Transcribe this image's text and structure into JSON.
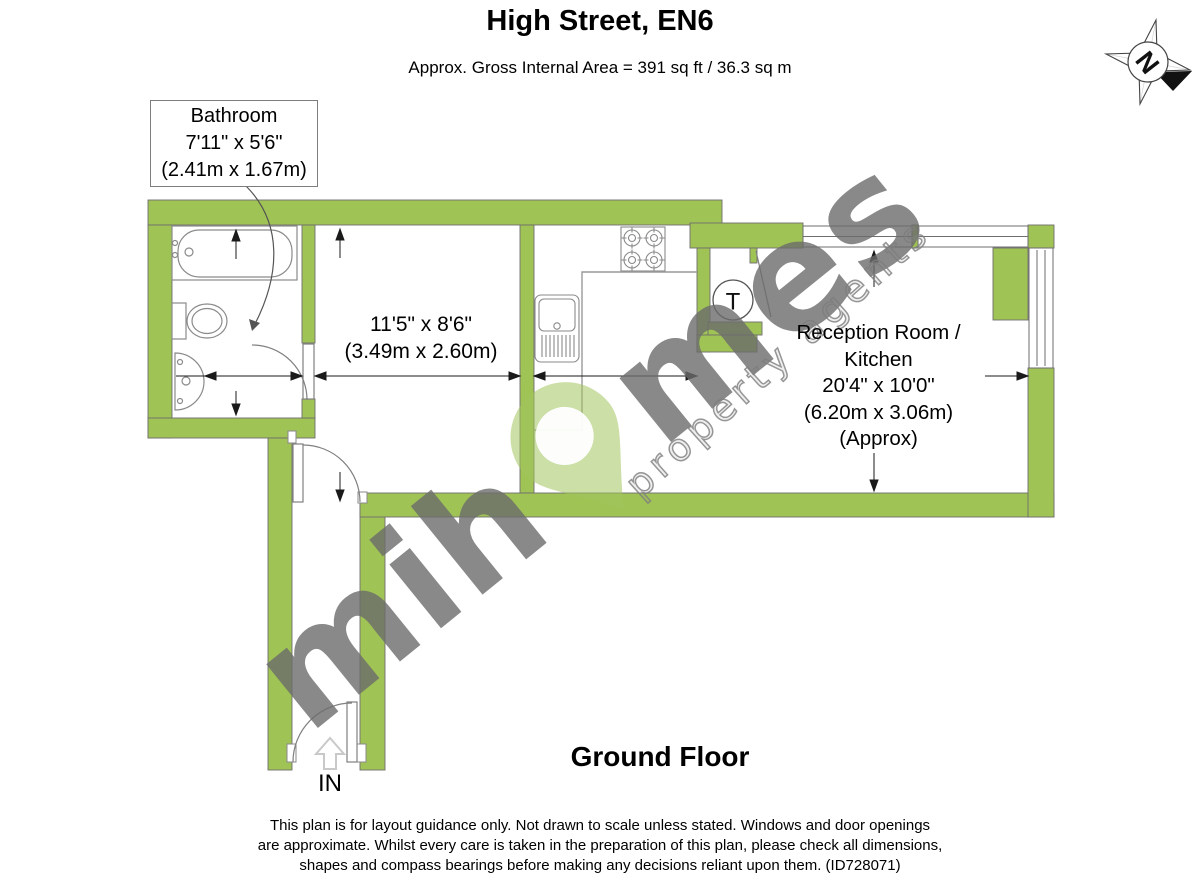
{
  "header": {
    "title": "High Street, EN6",
    "subtitle": "Approx. Gross Internal Area = 391 sq ft / 36.3 sq m"
  },
  "compass": {
    "north": "N"
  },
  "rooms": {
    "bathroom": {
      "name": "Bathroom",
      "size_imperial": "7'11\" x 5'6\"",
      "size_metric": "(2.41m x 1.67m)"
    },
    "room1": {
      "size_imperial": "11'5\" x 8'6\"",
      "size_metric": "(3.49m x 2.60m)"
    },
    "reception": {
      "name_line1": "Reception Room /",
      "name_line2": "Kitchen",
      "size_imperial": "20'4\" x 10'0\"",
      "size_metric": "(6.20m x 3.06m)",
      "approx": "(Approx)"
    },
    "tank_label": "T"
  },
  "plan": {
    "floor_label": "Ground Floor",
    "entrance_label": "IN"
  },
  "watermark": {
    "brand_prefix": "mih",
    "brand_suffix": "mes",
    "tagline": "property agents"
  },
  "footer": {
    "line1": "This plan is for layout guidance only. Not drawn to scale unless stated. Windows and door openings",
    "line2": "are approximate. Whilst every care is taken in the preparation of this plan, please check all dimensions,",
    "line3": "shapes and compass bearings before making any decisions reliant upon them. (ID728071)"
  },
  "colors": {
    "wall": "#a0c355",
    "watermark_pin": "#a3c55f",
    "watermark_text": "#6c6c6c"
  }
}
